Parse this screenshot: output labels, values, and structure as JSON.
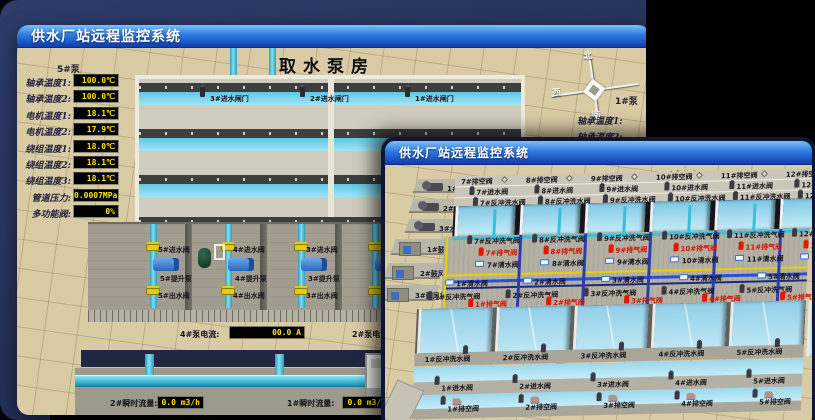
{
  "back_window": {
    "title": "供水厂站远程监控系统",
    "scene_title": "取水泵房",
    "pump_panel": {
      "header": "5#泵",
      "rows": [
        {
          "label": "轴承温度1:",
          "value": "100.0℃"
        },
        {
          "label": "轴承温度2:",
          "value": "100.0℃"
        },
        {
          "label": "电机温度1:",
          "value": "18.1℃"
        },
        {
          "label": "电机温度2:",
          "value": "17.9℃"
        },
        {
          "label": "绕组温度1:",
          "value": "18.0℃"
        },
        {
          "label": "绕组温度2:",
          "value": "18.1℃"
        },
        {
          "label": "绕组温度3:",
          "value": "18.1℃"
        },
        {
          "label": "管道压力:",
          "value": "0.0007MPa"
        },
        {
          "label": "多功能阀:",
          "value": "0%"
        }
      ]
    },
    "inlet_gates": [
      "3#进水闸门",
      "2#进水闸门",
      "1#进水闸门"
    ],
    "pump_bays": [
      {
        "inlet": "5#进水阀",
        "pump": "5#提升泵",
        "outlet": "5#出水阀"
      },
      {
        "inlet": "4#进水阀",
        "pump": "4#提升泵",
        "outlet": "4#出水阀"
      },
      {
        "inlet": "3#进水阀",
        "pump": "3#提升泵",
        "outlet": "3#出水阀"
      }
    ],
    "current_left": {
      "label": "4#泵电流:",
      "value": "00.0 A"
    },
    "current_right": {
      "label": "2#泵电流:"
    },
    "flow_left": {
      "label": "2#瞬时流量:",
      "value": "0.0 m3/h"
    },
    "flow_right": {
      "label": "1#瞬时流量:",
      "value": "0.0 m3/h"
    },
    "compass": {
      "north": "北",
      "west": "西",
      "south": "南"
    },
    "right_panel": {
      "header": "1#泵",
      "rows": [
        "轴承温度1:",
        "轴承温度2:"
      ]
    }
  },
  "front_window": {
    "title": "供水厂站远程监控系统",
    "scene_title": "1#V滤池",
    "pumps": [
      "1#水泵",
      "2#水泵",
      "3#水泵"
    ],
    "blowers": [
      "1#鼓风机",
      "2#鼓风机",
      "3#鼓风机"
    ],
    "top_cells": [
      {
        "drain": "7#排空阀",
        "inlet": "7#进水阀",
        "backwash_water": "7#反冲洗水阀",
        "backwash_air": "7#反冲洗气阀",
        "exhaust": "7#排气阀",
        "clean": "7#清水阀"
      },
      {
        "drain": "8#排空阀",
        "inlet": "8#进水阀",
        "backwash_water": "8#反冲洗水阀",
        "backwash_air": "8#反冲洗气阀",
        "exhaust": "8#排气阀",
        "clean": "8#清水阀"
      },
      {
        "drain": "9#排空阀",
        "inlet": "9#进水阀",
        "backwash_water": "9#反冲洗水阀",
        "backwash_air": "9#反冲洗气阀",
        "exhaust": "9#排气阀",
        "clean": "9#清水阀"
      },
      {
        "drain": "10#排空阀",
        "inlet": "10#进水阀",
        "backwash_water": "10#反冲洗水阀",
        "backwash_air": "10#反冲洗气阀",
        "exhaust": "10#排气阀",
        "clean": "10#清水阀"
      },
      {
        "drain": "11#排空阀",
        "inlet": "11#进水阀",
        "backwash_water": "11#反冲洗水阀",
        "backwash_air": "11#反冲洗气阀",
        "exhaust": "11#排气阀",
        "clean": "11#清水阀"
      },
      {
        "drain": "12#排空阀",
        "inlet": "12#进水阀",
        "backwash_water": "12#反冲洗水阀",
        "backwash_air": "12#反冲洗气阀",
        "exhaust": "12#排气阀",
        "clean": "12#清水阀"
      }
    ],
    "bottom_cells": [
      {
        "exhaust": "1#排气阀",
        "clean": "1#清水阀",
        "backwash_air": "1#反冲洗气阀",
        "backwash_water": "1#反冲洗水阀",
        "inlet": "1#进水阀",
        "drain": "1#排空阀"
      },
      {
        "exhaust": "2#排气阀",
        "clean": "2#清水阀",
        "backwash_air": "2#反冲洗气阀",
        "backwash_water": "2#反冲洗水阀",
        "inlet": "2#进水阀",
        "drain": "2#排空阀"
      },
      {
        "exhaust": "3#排气阀",
        "clean": "3#清水阀",
        "backwash_air": "3#反冲洗气阀",
        "backwash_water": "3#反冲洗水阀",
        "inlet": "3#进水阀",
        "drain": "3#排空阀"
      },
      {
        "exhaust": "4#排气阀",
        "clean": "4#清水阀",
        "backwash_air": "4#反冲洗气阀",
        "backwash_water": "4#反冲洗水阀",
        "inlet": "4#进水阀",
        "drain": "4#排空阀"
      },
      {
        "exhaust": "5#排气阀",
        "clean": "5#清水阀",
        "backwash_air": "5#反冲洗气阀",
        "backwash_water": "5#反冲洗水阀",
        "inlet": "5#进水阀",
        "drain": "5#排空阀"
      },
      {
        "exhaust": "6#排气阀",
        "clean": "6#清水阀",
        "backwash_air": "6#反冲洗气阀",
        "backwash_water": "6#反冲洗水阀",
        "inlet": "6#进水阀",
        "drain": "6#排空阀"
      }
    ]
  }
}
